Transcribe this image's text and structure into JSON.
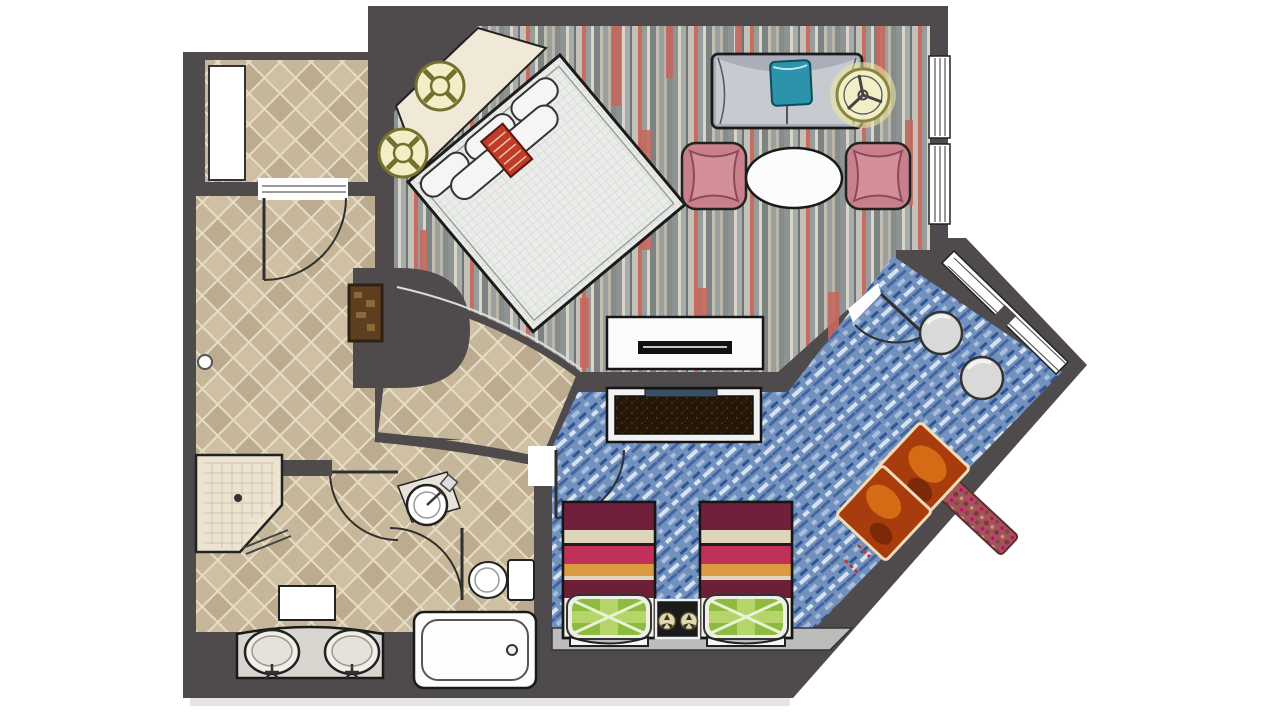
{
  "image": {
    "title": "Hotel suite floor plan",
    "description": "Top-down illustrated floor plan of a hotel suite: entry hall with diamond tile, living room with diagonal king bed and sofa seating on striped carpet, second bedroom with two twin beds on blue carpet, and a bathroom with shower, double vanity, toilet and bathtub."
  },
  "colors": {
    "wall": "#4f4a4c",
    "outline": "#1c1c1c",
    "tile": "#c6b69a",
    "platform": "#f0e9d7",
    "mattress": "#eaece9",
    "duvetInner": "#edefed",
    "pillow": "#f5f5f5",
    "redPillow": "#c23b28",
    "sofa": "#a9aeb8",
    "sofaSeat": "#c6cad1",
    "tealCushion": "#2b93aa",
    "chairPink": "#c8808c",
    "chairPinkInner": "#d28f9a",
    "table": "#fcfcfc",
    "consoleWhite": "#fbfbfb",
    "slotBlack": "#111111",
    "consoleDarkFrame": "#f2f2f2",
    "tvNavy": "#3c4f63",
    "symbolFill": "#f2efc6",
    "symbolRing": "#7a7434",
    "niche": "#5e3f1f",
    "carpetRed": "#c4685e",
    "duvet": [
      "#70203c",
      "#ddd6bc",
      "#1d1d1d",
      "#c03058",
      "#dc9a40",
      "#6d1f38"
    ],
    "greenPillow": "#8cbb40",
    "greenPillowLight": "#b5d46a",
    "nightstand": "#1b1b1b",
    "pouf": "#d9d9d9",
    "ottoman": "#a83c0c",
    "ottomanBorder": "#f0ddb8",
    "bench": "#a25555",
    "floorStrip": "#bcbcbc",
    "fixtureWhite": "#fdfdfd",
    "vanityCounter": "#d8d6ce",
    "shower": "#ece3d0",
    "window": "#ffffff"
  },
  "rooms": [
    {
      "id": "living-room",
      "floor": "gray-red striped carpet"
    },
    {
      "id": "second-bedroom",
      "floor": "blue mottled carpet"
    },
    {
      "id": "entry-hall",
      "floor": "beige diamond tile"
    },
    {
      "id": "bathroom",
      "floor": "beige diamond tile"
    }
  ],
  "furniture": [
    "king-bed",
    "headboard-platform",
    "bed-pillows",
    "red-accent-pillow",
    "sofa",
    "teal-cushion",
    "pink-armchair-left",
    "pink-armchair-right",
    "oval-coffee-table",
    "tv-console-living",
    "tv-console-bedroom",
    "closet",
    "wall-niche",
    "twin-bed-left",
    "twin-bed-right",
    "nightstand",
    "pouf-upper",
    "pouf-lower",
    "ottoman-upper",
    "ottoman-lower",
    "window-bench",
    "corner-shower",
    "double-vanity",
    "bath-mat",
    "pedestal-sink",
    "toilet",
    "bathtub"
  ],
  "symbols": [
    "ceiling-fan-symbol",
    "light-fixture-symbol-upper",
    "light-fixture-symbol-lower",
    "bedside-lamp-symbol-left",
    "bedside-lamp-symbol-right"
  ]
}
